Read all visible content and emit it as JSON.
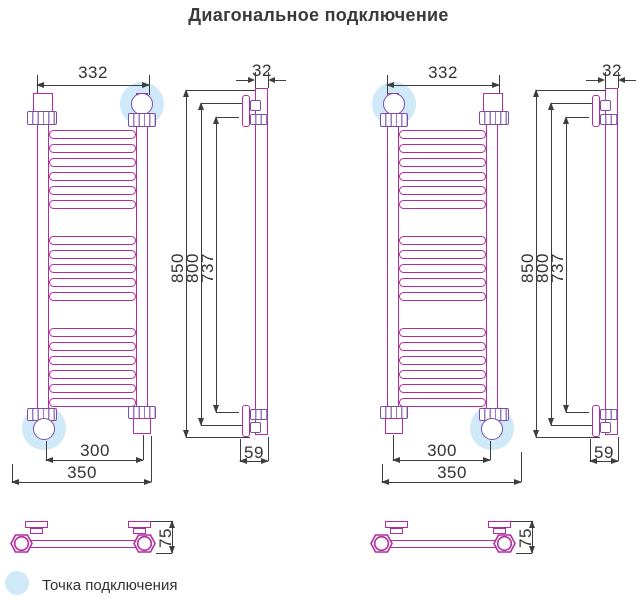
{
  "title": "Диагональное подключение",
  "legend": {
    "label": "Точка подключения",
    "dot_color": "#cfe9f8"
  },
  "colors": {
    "pipe_magenta": "#b12d9e",
    "fitting_violet": "#7a4ea8",
    "highlight_blue": "#cfe9f8",
    "dimension_lines": "#3e3e3e",
    "text": "#333333"
  },
  "rung_groups": [
    6,
    5,
    6
  ],
  "drawings": [
    {
      "id": "left",
      "connection_corners": [
        "top-right",
        "bottom-left"
      ],
      "dims": {
        "top_width": "332",
        "connection_spacing": "300",
        "total_width": "350",
        "total_height": "850",
        "tube_height": "800",
        "mount_span": "737",
        "top_depth": "32",
        "bottom_offset": "59",
        "wall_depth": "75"
      }
    },
    {
      "id": "right",
      "connection_corners": [
        "top-left",
        "bottom-right"
      ],
      "dims": {
        "top_width": "332",
        "connection_spacing": "300",
        "total_width": "350",
        "total_height": "850",
        "tube_height": "800",
        "mount_span": "737",
        "top_depth": "32",
        "bottom_offset": "59",
        "wall_depth": "75"
      }
    }
  ]
}
